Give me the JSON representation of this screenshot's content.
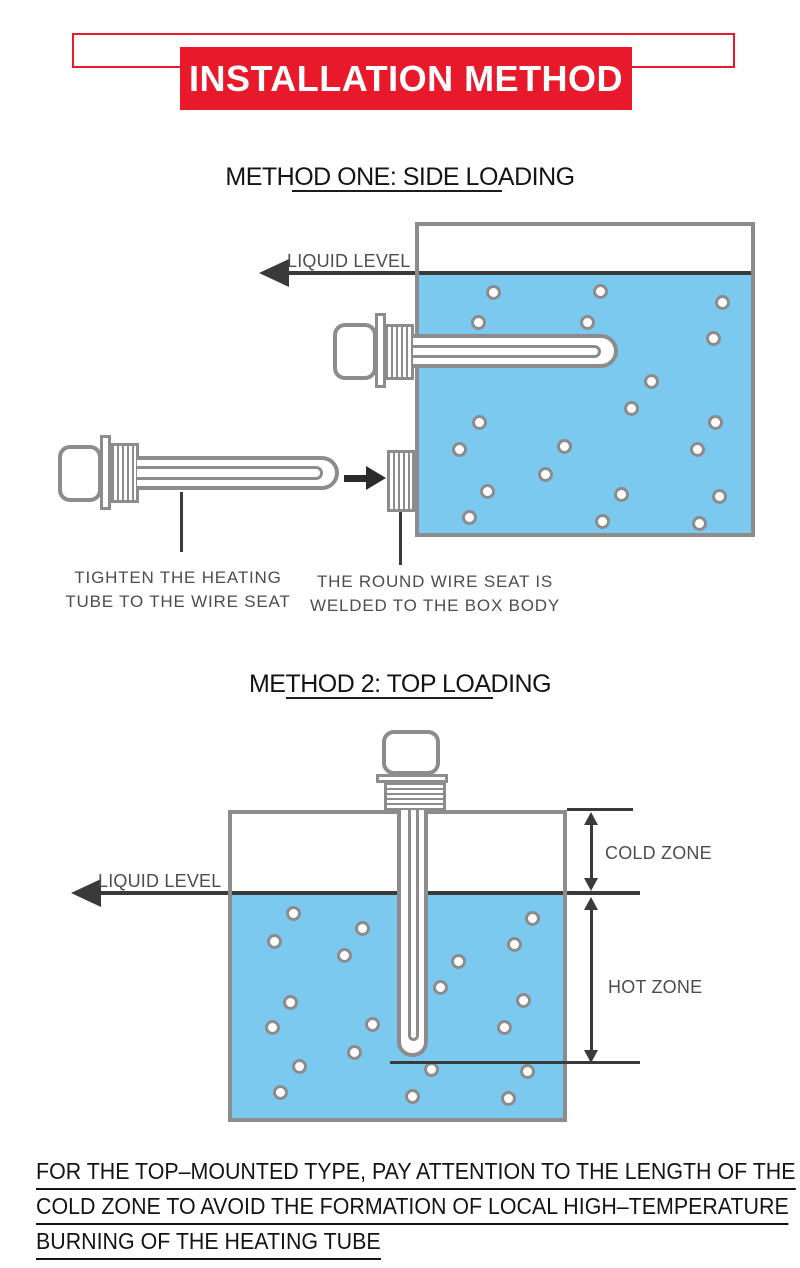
{
  "banner": {
    "title": "INSTALLATION METHOD"
  },
  "colors": {
    "red": "#E8192B",
    "water": "#7CC9F0",
    "outline": "#8C8C8C",
    "dark": "#3A3A3A",
    "label": "#4D4D4D"
  },
  "method1": {
    "heading": "METHOD ONE: SIDE LOADING",
    "liquid_level_label": "LIQUID LEVEL",
    "caption_left_line1": "TIGHTEN THE HEATING",
    "caption_left_line2": "TUBE TO THE WIRE SEAT",
    "caption_right_line1": "THE ROUND WIRE SEAT IS",
    "caption_right_line2": "WELDED TO THE BOX BODY",
    "bubbles": [
      [
        493,
        292
      ],
      [
        600,
        291
      ],
      [
        722,
        302
      ],
      [
        478,
        322
      ],
      [
        587,
        322
      ],
      [
        713,
        338
      ],
      [
        651,
        381
      ],
      [
        631,
        408
      ],
      [
        479,
        422
      ],
      [
        715,
        422
      ],
      [
        459,
        449
      ],
      [
        564,
        446
      ],
      [
        697,
        449
      ],
      [
        545,
        474
      ],
      [
        487,
        491
      ],
      [
        621,
        494
      ],
      [
        719,
        496
      ],
      [
        469,
        517
      ],
      [
        602,
        521
      ],
      [
        699,
        523
      ]
    ]
  },
  "method2": {
    "heading": "METHOD 2: TOP LOADING",
    "liquid_level_label": "LIQUID LEVEL",
    "cold_zone_label": "COLD ZONE",
    "hot_zone_label": "HOT ZONE",
    "bubbles": [
      [
        293,
        913
      ],
      [
        274,
        941
      ],
      [
        362,
        928
      ],
      [
        344,
        955
      ],
      [
        290,
        1002
      ],
      [
        272,
        1027
      ],
      [
        354,
        1052
      ],
      [
        372,
        1024
      ],
      [
        299,
        1066
      ],
      [
        280,
        1092
      ],
      [
        412,
        1096
      ],
      [
        431,
        1069
      ],
      [
        440,
        987
      ],
      [
        458,
        961
      ],
      [
        532,
        918
      ],
      [
        514,
        944
      ],
      [
        523,
        1000
      ],
      [
        504,
        1027
      ],
      [
        527,
        1071
      ],
      [
        508,
        1098
      ]
    ]
  },
  "footer": {
    "lines": [
      "FOR THE TOP–MOUNTED TYPE, PAY ATTENTION TO THE LENGTH OF THE",
      "COLD ZONE TO AVOID THE FORMATION OF LOCAL HIGH–TEMPERATURE",
      "BURNING OF THE HEATING TUBE"
    ]
  }
}
